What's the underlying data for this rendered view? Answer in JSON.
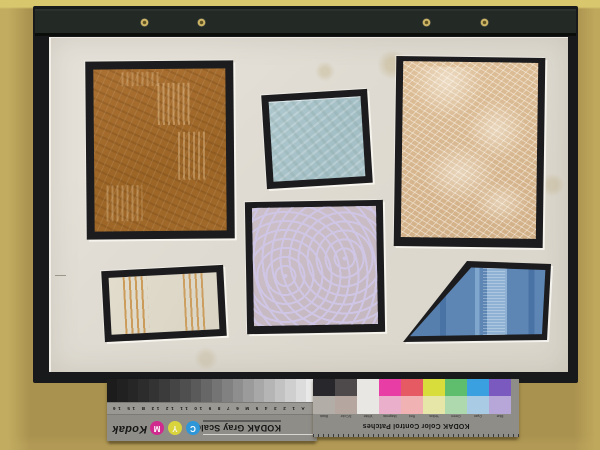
{
  "photo": {
    "subject": "Textile sample board: six fabric swatches mounted on black board with cream mat, Kodak calibration strips placed upside down at bottom",
    "background_color": "#a9924f",
    "board_color": "#17191b",
    "mat_color": "#dfdbd2"
  },
  "swatches": [
    {
      "id": "brown-diagonal-weave",
      "color": "#a16a2a"
    },
    {
      "id": "light-blue-square",
      "color": "#a9c3c9"
    },
    {
      "id": "tan-fern-damask",
      "color": "#d9b88f"
    },
    {
      "id": "lavender-maze",
      "color": "#c9bcc6"
    },
    {
      "id": "cream-orange-stripes",
      "color": "#ded8c8",
      "stripe_color": "#c79045"
    },
    {
      "id": "blue-trapezoid",
      "color": "#5d86b5"
    }
  ],
  "gray_scale": {
    "brand": "Kodak",
    "title": "KODAK Gray Scale",
    "index_labels": "A 1 2 3 4 5 M 6 7 8 9 10 11 12 13 B 15 16 17 19",
    "dots": [
      {
        "letter": "C",
        "color": "#2f96d8",
        "text_color": "#ffffff"
      },
      {
        "letter": "Y",
        "color": "#d9d43c",
        "text_color": "#f8f8e8"
      },
      {
        "letter": "M",
        "color": "#d02a8e",
        "text_color": "#ffffff"
      }
    ],
    "step_colors": [
      "#e9e9e9",
      "#dcdcdc",
      "#cfcfcf",
      "#c2c2c2",
      "#b5b5b5",
      "#a8a8a8",
      "#9b9b9b",
      "#8e8e8e",
      "#818181",
      "#747474",
      "#676767",
      "#5a5a5a",
      "#4f4f4f",
      "#454545",
      "#3b3b3b",
      "#333333",
      "#2c2c2c",
      "#262626",
      "#212121",
      "#1c1c1c"
    ]
  },
  "color_patches": {
    "brand": "Kodak",
    "title": "KODAK Color Control Patches",
    "columns": [
      {
        "label": "Blue",
        "top": "#7a5abe",
        "bottom": "#b7a6d8"
      },
      {
        "label": "Cyan",
        "top": "#3ba0e0",
        "bottom": "#a9cbe4"
      },
      {
        "label": "Green",
        "top": "#5fbe6e",
        "bottom": "#aed8ae"
      },
      {
        "label": "Yellow",
        "top": "#d8dd3c",
        "bottom": "#e6e6a8"
      },
      {
        "label": "Red",
        "top": "#e65a64",
        "bottom": "#f0b2b2"
      },
      {
        "label": "Magenta",
        "top": "#e83da4",
        "bottom": "#eab0cb"
      },
      {
        "label": "White",
        "top": "#e9e7e4",
        "bottom": "#e9e7e4"
      },
      {
        "label": "3/Color",
        "top": "#4e4a4c",
        "bottom": "#b5a7a0"
      },
      {
        "label": "Black",
        "top": "#28282c",
        "bottom": "#b3ada7"
      }
    ]
  }
}
